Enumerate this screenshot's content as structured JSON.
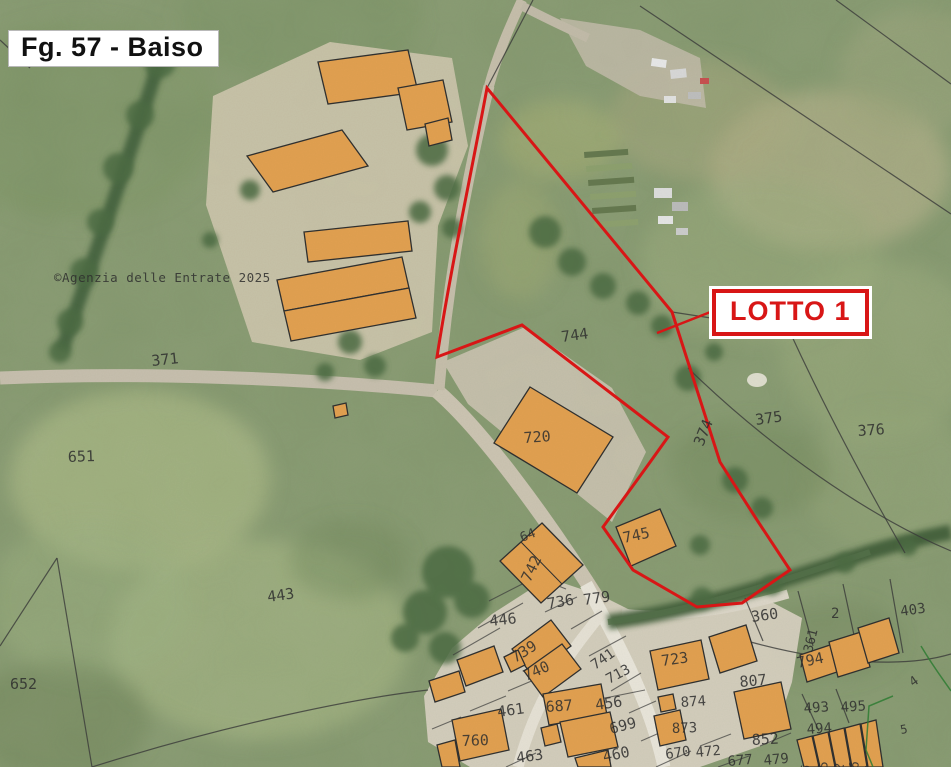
{
  "map": {
    "title": "Fg. 57 - Baiso",
    "lot_label": "LOTTO 1",
    "copyright": "©Agenzia delle Entrate 2025",
    "colors": {
      "lot_boundary_red": "#d81616",
      "building_orange": "#e2a050",
      "parcel_line_black": "#3a3a3a",
      "special_boundary_green": "#2e7d32",
      "label_gray": "#2e2e2e",
      "copyright_red": "#c03030"
    },
    "parcels": {
      "p371": "371",
      "p651": "651",
      "p652": "652",
      "p443": "443",
      "p744": "744",
      "p720": "720",
      "p745": "745",
      "p374": "374",
      "p375": "375",
      "p376": "376",
      "p64": "64",
      "p742": "742",
      "p736": "736",
      "p779": "779",
      "p446": "446",
      "p739": "739",
      "p740": "740",
      "p741": "741",
      "p713": "713",
      "p723": "723",
      "p687": "687",
      "p456": "456",
      "p699": "699",
      "p461": "461",
      "p760": "760",
      "p463": "463",
      "p460": "460",
      "p874": "874",
      "p873": "873",
      "p852": "852",
      "p670": "670",
      "p472": "472",
      "p677": "677",
      "p479": "479",
      "p807": "807",
      "p360": "360",
      "p2": "2",
      "p403": "403",
      "p361": "361",
      "p794": "794",
      "p493": "493",
      "p495": "495",
      "p494": "494",
      "p4": "4",
      "p5": "5",
      "v96": "96",
      "v795": "795",
      "v792": "792",
      "v796": "796",
      "v87": "87"
    }
  }
}
